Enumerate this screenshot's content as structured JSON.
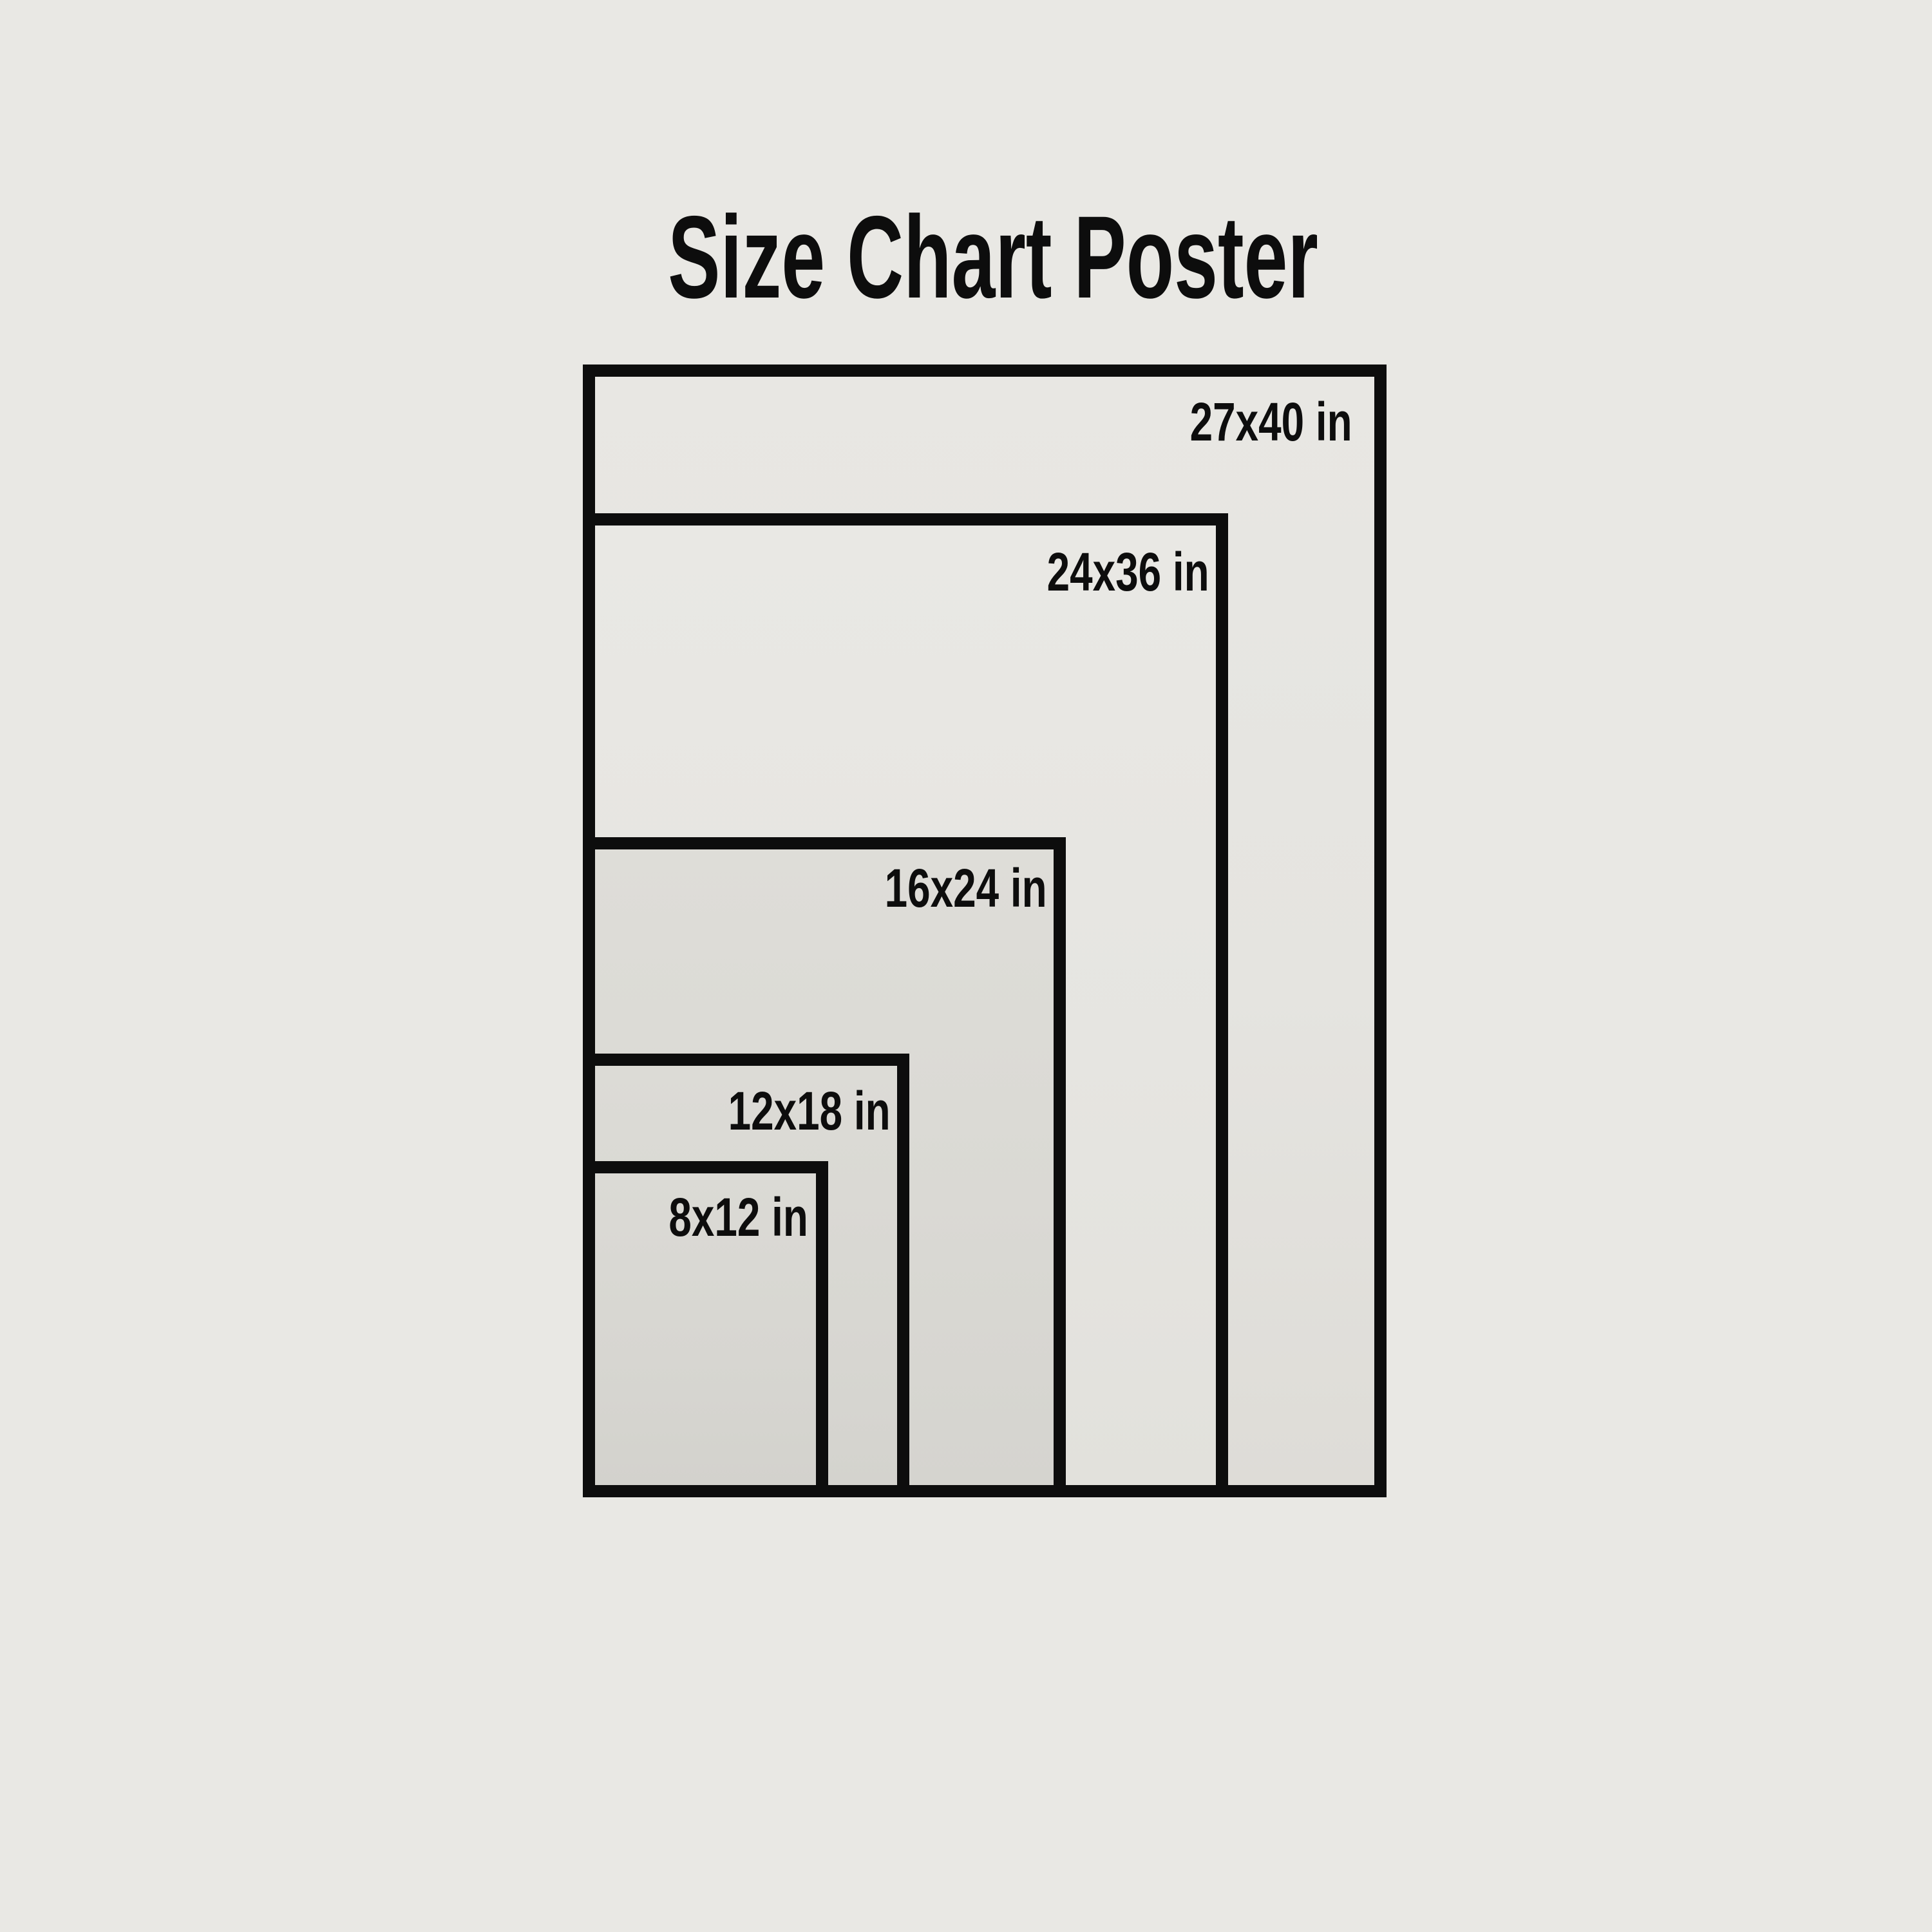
{
  "title": "Size Chart Poster",
  "unit": "in",
  "sizes": [
    {
      "label": "27x40 in",
      "width_in": 27,
      "height_in": 40
    },
    {
      "label": "24x36 in",
      "width_in": 24,
      "height_in": 36
    },
    {
      "label": "16x24 in",
      "width_in": 16,
      "height_in": 24
    },
    {
      "label": "12x18 in",
      "width_in": 12,
      "height_in": 18
    },
    {
      "label": "8x12 in",
      "width_in": 8,
      "height_in": 12
    }
  ],
  "colors": {
    "background": "#e9e8e4",
    "line": "#0d0d0d",
    "text": "#0d0d0d"
  }
}
